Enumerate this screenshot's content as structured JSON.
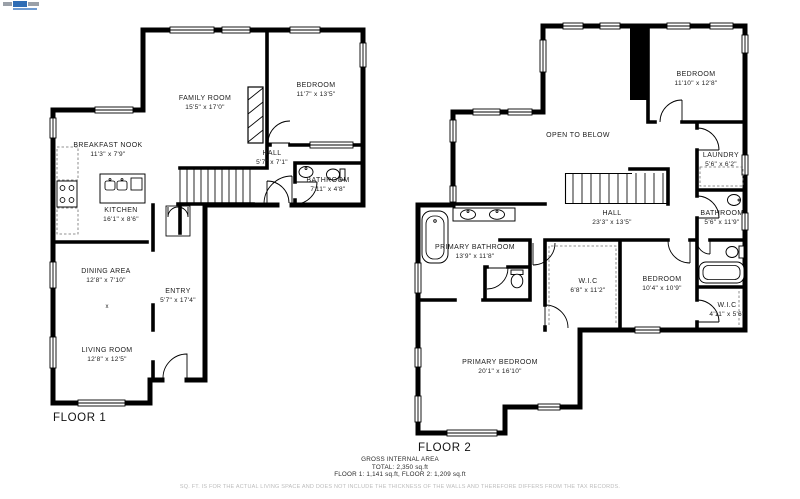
{
  "logo": {
    "name": "brand-logo"
  },
  "floor1": {
    "title": "FLOOR 1",
    "marker": "x",
    "rooms": [
      {
        "name": "FAMILY ROOM",
        "dims": "15'5\" x 17'0\""
      },
      {
        "name": "BEDROOM",
        "dims": "11'7\" x 13'5\""
      },
      {
        "name": "BREAKFAST NOOK",
        "dims": "11'3\" x 7'9\""
      },
      {
        "name": "KITCHEN",
        "dims": "16'1\" x 8'6\""
      },
      {
        "name": "HALL",
        "dims": "5'7\" x 7'1\""
      },
      {
        "name": "BATHROOM",
        "dims": "7'11\" x 4'8\""
      },
      {
        "name": "DINING AREA",
        "dims": "12'8\" x 7'10\""
      },
      {
        "name": "ENTRY",
        "dims": "5'7\" x 17'4\""
      },
      {
        "name": "LIVING ROOM",
        "dims": "12'8\" x 12'5\""
      }
    ]
  },
  "floor2": {
    "title": "FLOOR 2",
    "rooms": [
      {
        "name": "BEDROOM",
        "dims": "11'10\" x 12'8\""
      },
      {
        "name": "OPEN TO BELOW",
        "dims": ""
      },
      {
        "name": "LAUNDRY",
        "dims": "5'6\" x 6'2\""
      },
      {
        "name": "HALL",
        "dims": "23'3\" x 13'5\""
      },
      {
        "name": "BATHROOM",
        "dims": "5'6\" x 11'9\""
      },
      {
        "name": "PRIMARY BATHROOM",
        "dims": "13'9\" x 11'8\""
      },
      {
        "name": "W.I.C",
        "dims": "6'8\" x 11'2\""
      },
      {
        "name": "BEDROOM",
        "dims": "10'4\" x 10'9\""
      },
      {
        "name": "W.I.C",
        "dims": "4'11\" x 5'6\""
      },
      {
        "name": "PRIMARY BEDROOM",
        "dims": "20'1\" x 16'10\""
      }
    ]
  },
  "summary": {
    "heading": "GROSS INTERNAL AREA",
    "total": "TOTAL: 2,350 sq.ft",
    "floors": "FLOOR 1: 1,141 sq.ft, FLOOR 2: 1,209 sq.ft"
  },
  "disclaimer": "SQ. FT. IS FOR THE ACTUAL LIVING SPACE AND DOES NOT INCLUDE THE THICKNESS OF THE WALLS AND THEREFORE DIFFERS FROM THE TAX RECORDS.",
  "colors": {
    "wall": "#000000",
    "text": "#1c1c1c",
    "muted": "#bcbcbc",
    "logo_blue": "#2f6db5",
    "logo_gray": "#9aa0a8"
  }
}
